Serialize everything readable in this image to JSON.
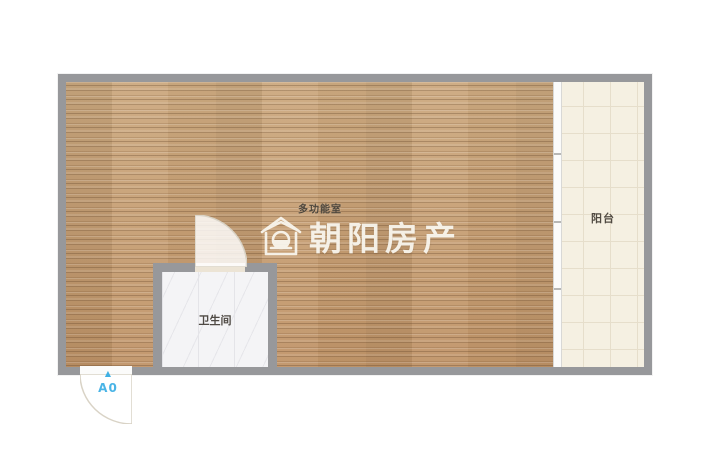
{
  "floorplan": {
    "main_room_label": "多功能室",
    "bathroom_label": "卫生间",
    "balcony_label": "阳台",
    "watermark_text": "朝阳房产",
    "entrance_label": "A0",
    "entrance_marker": "▲",
    "colors": {
      "wall": "#97989b",
      "wood_floor": "#c39a6f",
      "balcony_floor": "#f5f0e2",
      "balcony_grid": "#e6decb",
      "bathroom_floor": "#f4f4f6",
      "watermark": "#faf8f1",
      "entrance_accent": "#3fb0e4"
    }
  }
}
